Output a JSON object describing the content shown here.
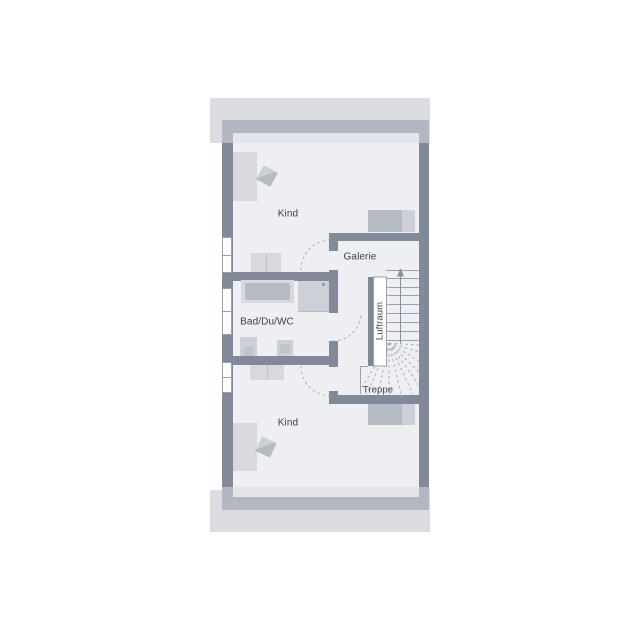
{
  "title": "Dachgeschoss Grundriss",
  "rooms": {
    "kind_top": "Kind",
    "galerie": "Galerie",
    "bad": "Bad/Du/WC",
    "kind_bottom": "Kind",
    "luftraum": "Luftraum",
    "treppe": "Treppe"
  },
  "stairs": {
    "direction": "up",
    "straight_treads": 8
  },
  "windows": {
    "left_wall_count": 3
  },
  "doors": {
    "swing_count": 3
  },
  "colors": {
    "background": "#ffffff",
    "roof": "#dbdde2",
    "roof_shadow": "rgba(218,221,227,0.55)",
    "floor": "#edeff3",
    "wall": "#828a99",
    "wall_thin": "#7f8795",
    "line": "#9aa1ac",
    "dash": "#a6acb6",
    "walkline": "#88909c",
    "furniture_light": "#d7d9de",
    "furniture_mid": "#b6bac2",
    "furniture_div": "#c0c3ca",
    "fixture": "#cdd0d6",
    "fixture_inner": "#bfc3cb",
    "void_fill": "#ffffff",
    "drain": "#8a919d",
    "text": "#3b3f48"
  }
}
